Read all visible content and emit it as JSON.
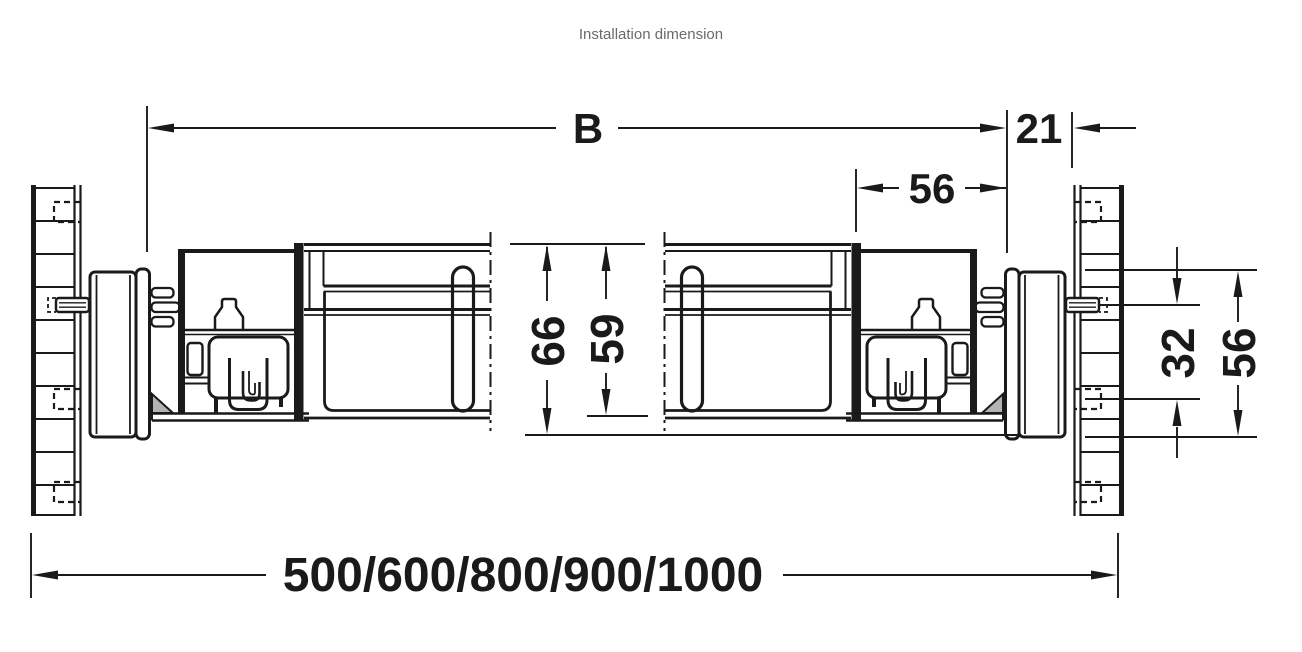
{
  "title": "Installation dimension",
  "dims": {
    "b": "B",
    "gap21": "21",
    "depth56": "56",
    "h66": "66",
    "h59": "59",
    "pitch32": "32",
    "h56": "56",
    "lengths": "500/600/800/900/1000"
  },
  "colors": {
    "line": "#1a1a1a",
    "background": "#ffffff",
    "title_text": "#6b6b6b",
    "shading": "#b3b3b3"
  }
}
